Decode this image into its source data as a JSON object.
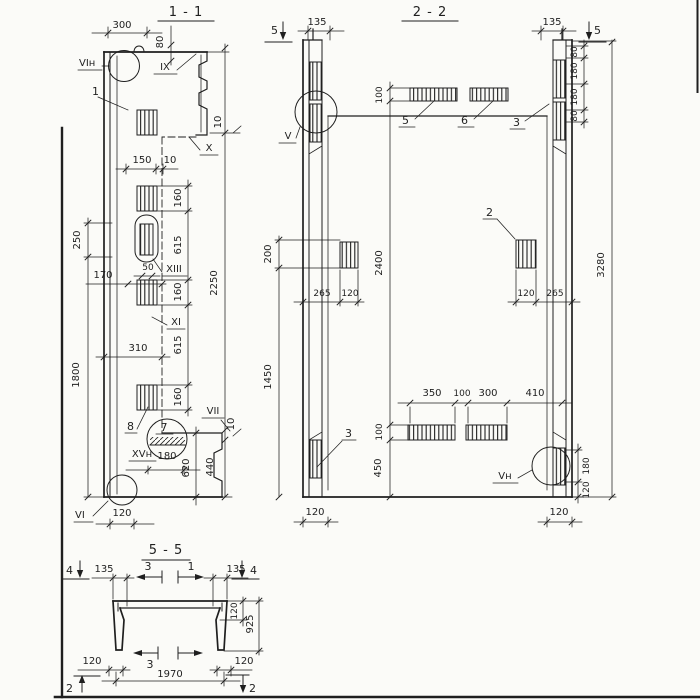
{
  "drawing": {
    "colors": {
      "ink": "#1f1f1f",
      "paper": "#fbfbf8"
    }
  },
  "s11": {
    "title": "1 - 1",
    "markers": {
      "vi_top": "VIн",
      "ix": "IX",
      "x": "X",
      "xiii": "XIII",
      "xi": "XI",
      "vii": "VII",
      "xv": "XVн",
      "vi_bot": "VI"
    },
    "parts": {
      "p1": "1",
      "p8": "8",
      "p7": "7"
    },
    "dims": {
      "d300": "300",
      "d80": "80",
      "d10a": "10",
      "d150": "150",
      "d10b": "10",
      "d160a": "160",
      "d615a": "615",
      "d160b": "160",
      "d615b": "615",
      "d160c": "160",
      "d2250": "2250",
      "d250": "250",
      "d1800": "1800",
      "d170": "170",
      "d50": "50",
      "d310": "310",
      "d10c": "10",
      "d440": "440",
      "d620": "620",
      "d180": "180",
      "d120": "120"
    }
  },
  "s22": {
    "title": "2 - 2",
    "markers": {
      "m5l": "5",
      "m5r": "5",
      "v": "V",
      "vn": "Vн"
    },
    "parts": {
      "p5": "5",
      "p6": "6",
      "p3t": "3",
      "p2": "2",
      "p3b": "3"
    },
    "dims": {
      "d135l": "135",
      "d135r": "135",
      "c80a": "80",
      "c180a": "180",
      "c180b": "180",
      "c80b": "80",
      "d100t": "100",
      "d200": "200",
      "d2400": "2400",
      "d1450": "1450",
      "d265l": "265",
      "d120l": "120",
      "d120r": "120",
      "d265r": "265",
      "d3280": "3280",
      "d350": "350",
      "d100m": "100",
      "d300": "300",
      "d410": "410",
      "d100b": "100",
      "d450": "450",
      "d180r": "180",
      "d120rr": "120",
      "d120bl": "120",
      "d120br": "120"
    }
  },
  "s55": {
    "title": "5 - 5",
    "markers": {
      "m4l": "4",
      "m4r": "4",
      "m3t": "3",
      "m1t": "1",
      "m3b": "3",
      "m2l": "2",
      "m2r": "2"
    },
    "dims": {
      "d135l": "135",
      "d135r": "135",
      "d120r": "120",
      "d925": "925",
      "d120bl": "120",
      "d120br": "120",
      "d1970": "1970"
    }
  }
}
